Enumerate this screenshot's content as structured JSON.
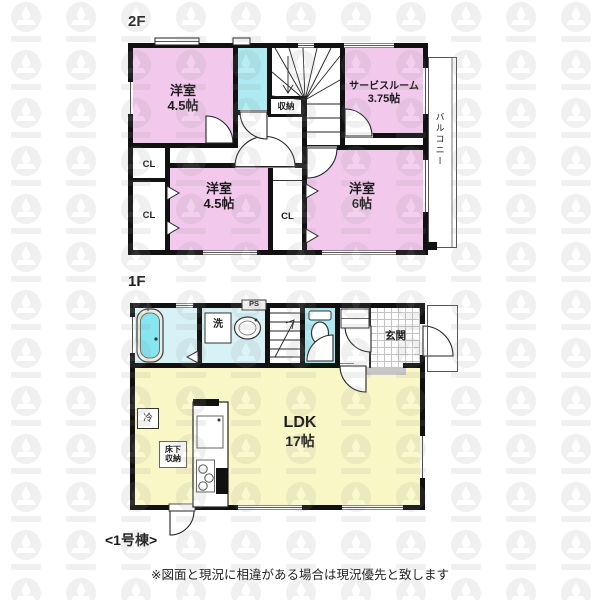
{
  "colors": {
    "room_pink": "#f2c9ec",
    "water_cyan": "#aeeaf2",
    "water_light": "#d7f2f7",
    "ldk_yellow": "#f9f7c5",
    "wall": "#111111",
    "tile_line": "#c4c4c4"
  },
  "floor2": {
    "label": "2F",
    "room_a": {
      "name": "洋室",
      "size": "4.5帖"
    },
    "service_room": {
      "name": "サービスルーム",
      "size": "3.75帖"
    },
    "room_b": {
      "name": "洋室",
      "size": "4.5帖"
    },
    "room_c": {
      "name": "洋室",
      "size": "6帖"
    },
    "storage": "収納",
    "balcony": "バルコニー",
    "closet_left_top": "CL",
    "closet_left_bottom": "CL",
    "closet_middle": "CL"
  },
  "floor1": {
    "label": "1F",
    "ldk": {
      "name": "LDK",
      "size": "17帖"
    },
    "entrance": "玄関",
    "washer": "洗",
    "pipe_space": "PS",
    "fridge": "冷",
    "floor_storage": {
      "line1": "床下",
      "line2": "収納"
    }
  },
  "footer": {
    "building": "<1号棟>",
    "disclaimer": "※図面と現況に相違がある場合は現況優先と致します"
  }
}
